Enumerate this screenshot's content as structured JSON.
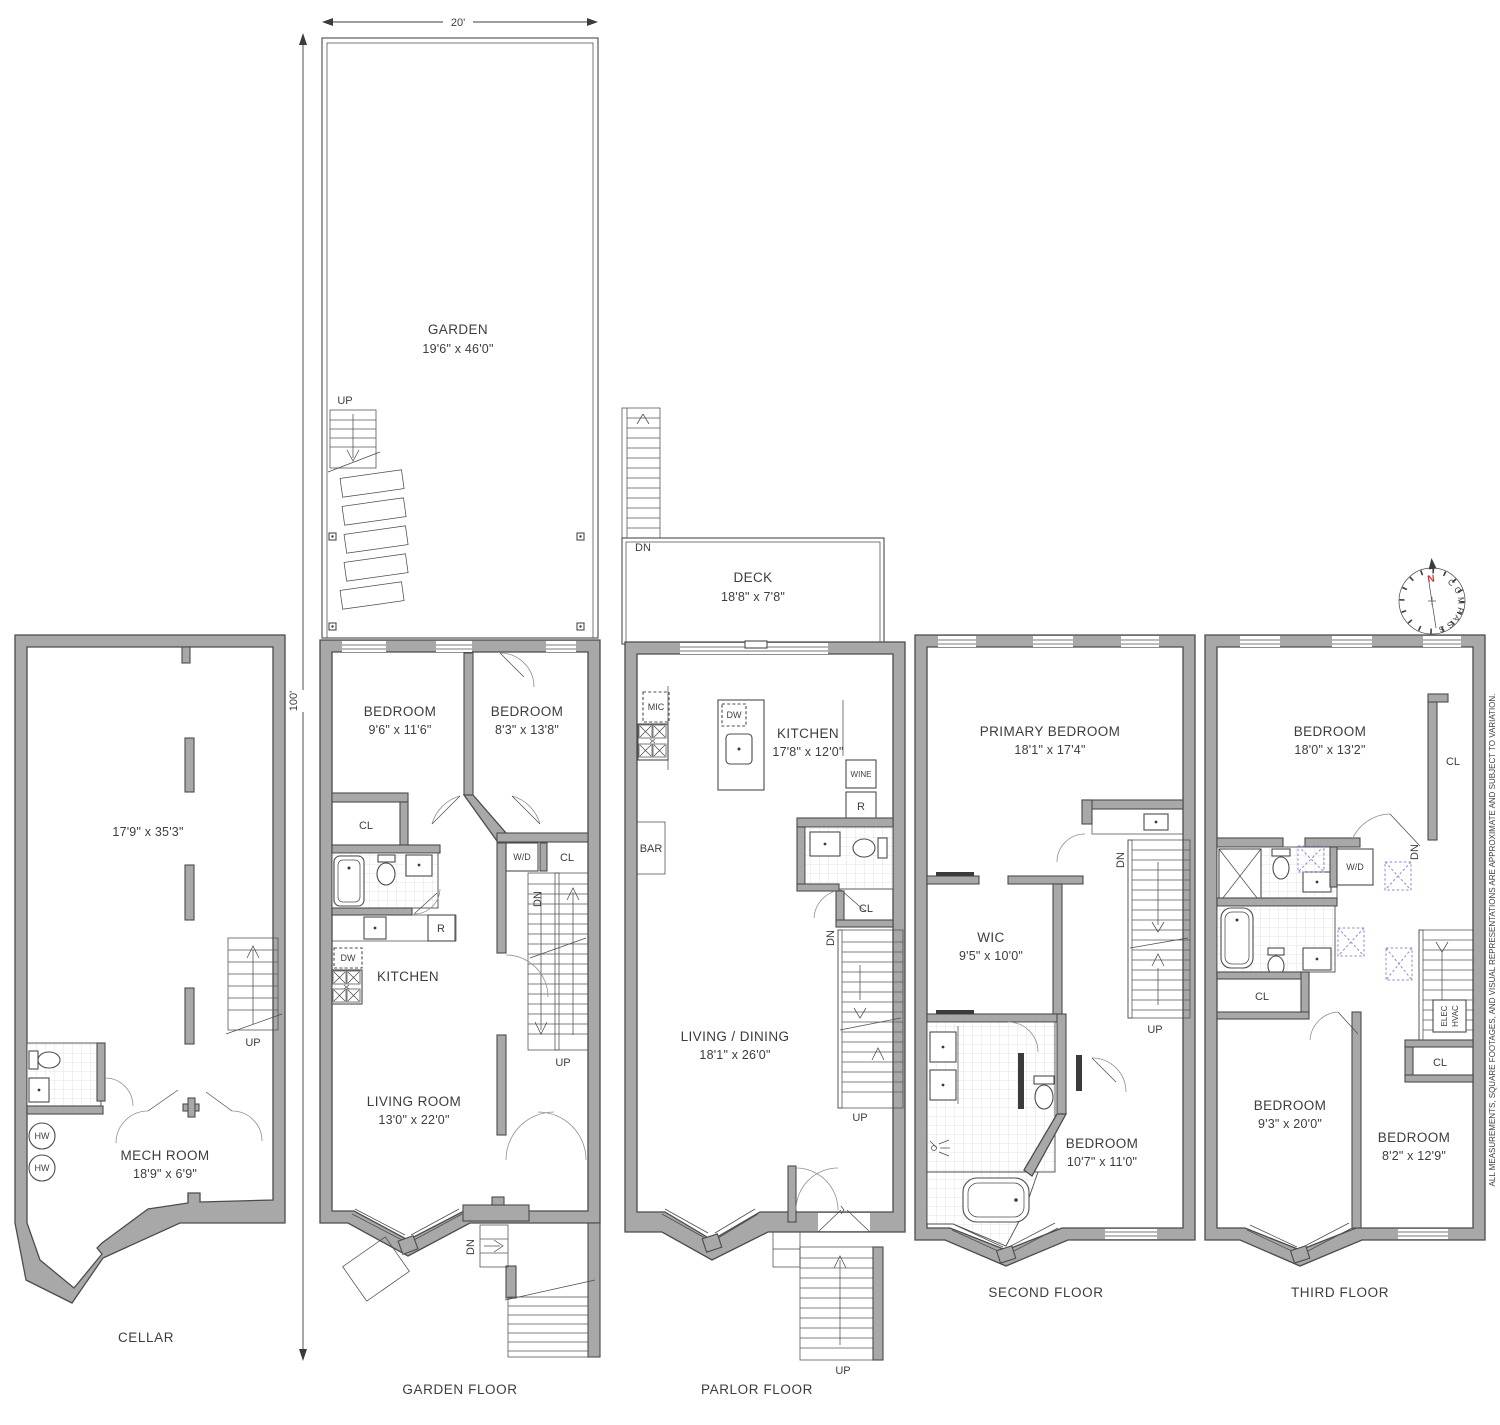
{
  "colors": {
    "wall_fill": "#a8a8a8",
    "line": "#4c4c4c",
    "skylight_blue": "#8a8ad2",
    "north_red": "#d23737",
    "tile_gray": "#dcdcdc"
  },
  "scale": {
    "width_label": "20'",
    "height_label": "100'"
  },
  "compass": {
    "word": "COMPASS",
    "north_label": "N"
  },
  "disclaimer": "ALL MEASUREMENTS, SQUARE FOOTAGES, AND VISUAL REPRESENTATIONS ARE APPROXIMATE AND SUBJECT TO VARIATION.",
  "floors": {
    "cellar": {
      "label": "CELLAR",
      "main_dims": "17'9\" x 35'3\"",
      "mech_name": "MECH ROOM",
      "mech_dims": "18'9\" x 6'9\"",
      "stairs_up": "UP",
      "water_heater": "HW"
    },
    "garden": {
      "label": "GARDEN FLOOR",
      "garden_name": "GARDEN",
      "garden_dims": "19'6\" x 46'0\"",
      "garden_stairs_up": "UP",
      "bedroom1_name": "BEDROOM",
      "bedroom1_dims": "9'6\" x 11'6\"",
      "bedroom2_name": "BEDROOM",
      "bedroom2_dims": "8'3\" x 13'8\"",
      "closet1": "CL",
      "washer_dryer": "W/D",
      "closet2": "CL",
      "stairs_dn": "DN",
      "stairs_up": "UP",
      "kitchen_name": "KITCHEN",
      "dishwasher": "DW",
      "refrigerator": "R",
      "living_name": "LIVING ROOM",
      "living_dims": "13'0\" x 22'0\"",
      "entry_dn": "DN"
    },
    "parlor": {
      "label": "PARLOR FLOOR",
      "deck_name": "DECK",
      "deck_dims": "18'8\" x 7'8\"",
      "deck_stairs_dn": "DN",
      "kitchen_name": "KITCHEN",
      "kitchen_dims": "17'8\" x 12'0\"",
      "microwave": "MIC",
      "dishwasher": "DW",
      "wine": "WINE",
      "refrigerator": "R",
      "bar": "BAR",
      "closet": "CL",
      "stairs_dn": "DN",
      "stairs_up": "UP",
      "living_name": "LIVING / DINING",
      "living_dims": "18'1\" x 26'0\"",
      "stoop_up": "UP"
    },
    "second": {
      "label": "SECOND FLOOR",
      "primary_name": "PRIMARY BEDROOM",
      "primary_dims": "18'1\" x 17'4\"",
      "wic_name": "WIC",
      "wic_dims": "9'5\" x 10'0\"",
      "bedroom_name": "BEDROOM",
      "bedroom_dims": "10'7\" x 11'0\"",
      "stairs_dn": "DN",
      "stairs_up": "UP"
    },
    "third": {
      "label": "THIRD FLOOR",
      "bedroom1_name": "BEDROOM",
      "bedroom1_dims": "18'0\" x 13'2\"",
      "closet1": "CL",
      "washer_dryer": "W/D",
      "stairs_dn": "DN",
      "closet2": "CL",
      "elec": "ELEC",
      "hvac": "HVAC",
      "closet3": "CL",
      "bedroom2_name": "BEDROOM",
      "bedroom2_dims": "9'3\" x 20'0\"",
      "bedroom3_name": "BEDROOM",
      "bedroom3_dims": "8'2\" x 12'9\""
    }
  }
}
